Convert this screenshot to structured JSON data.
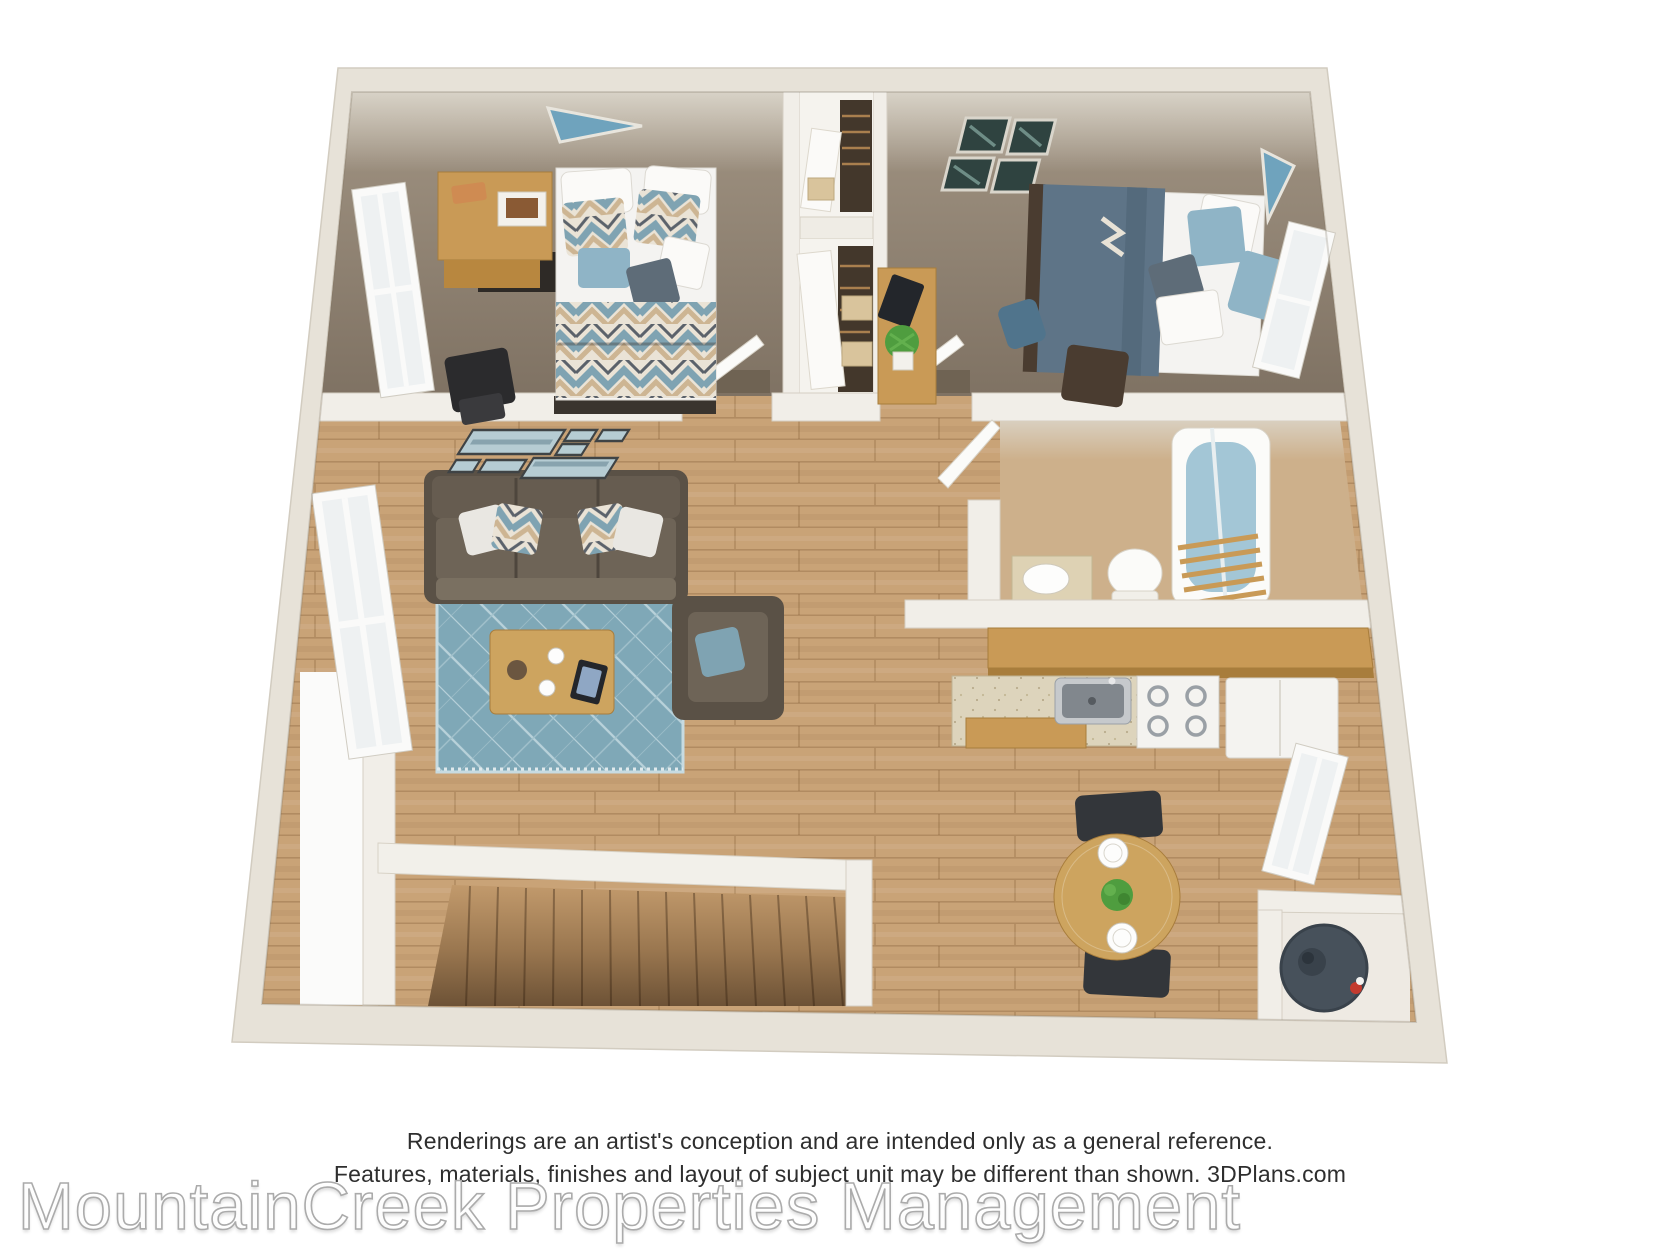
{
  "footer": {
    "disclaimer_line1": "Renderings are an artist's conception and are intended only as a general reference.",
    "disclaimer_line2": "Features, materials, finishes and layout of subject unit may be different than shown. 3DPlans.com",
    "watermark": "MountainCreek Properties Management",
    "brand": "3DPlans.com"
  },
  "palette": {
    "background": "#ffffff",
    "wall_cream": "#e7e2d8",
    "wall_inner_face": "#dedace",
    "interior_wall_white": "#f1eee8",
    "carpet_taupe": "#87796a",
    "wood_floor": "#c9a377",
    "stair_wood_dark": "#6d5236",
    "rug_blue": "#7fa8b7",
    "sofa_brown": "#5a5146",
    "oak_furniture": "#c99a56",
    "duvet_slate_blue": "#5e7487",
    "pillow_light_blue": "#8fb4c6",
    "tub_water_blue": "#a3c6d6",
    "appliance_white": "#f4f3f0",
    "water_heater_slate": "#47515b",
    "art_blue": "#6fa3bd"
  },
  "floorplan": {
    "type": "3d-top-down-apartment-rendering",
    "rooms": [
      {
        "name": "bedroom-1",
        "furniture": [
          "double-bed-chevron-duvet",
          "oak-desk",
          "black-chair",
          "closet",
          "left-wall-window",
          "blue-wall-art"
        ]
      },
      {
        "name": "bedroom-2",
        "furniture": [
          "bed-slate-duvet",
          "oak-desk-with-plant",
          "backpack",
          "chair",
          "gallery-pictures",
          "right-wall-window",
          "blue-wall-art"
        ]
      },
      {
        "name": "hallway",
        "furniture": [
          "bedroom-door-1",
          "bedroom-door-2"
        ]
      },
      {
        "name": "bathroom",
        "furniture": [
          "vanity-sink",
          "toilet",
          "bathtub",
          "towel-ladder",
          "bathroom-door"
        ]
      },
      {
        "name": "kitchen",
        "furniture": [
          "upper-cabinets",
          "counter-with-sink",
          "stove",
          "refrigerator"
        ]
      },
      {
        "name": "living-room",
        "furniture": [
          "sofa",
          "area-rug",
          "coffee-table",
          "armchair",
          "ocean-art-collage",
          "left-wall-window"
        ]
      },
      {
        "name": "dining-area",
        "furniture": [
          "round-table",
          "two-chairs",
          "place-settings",
          "plant-centerpiece",
          "right-wall-window"
        ]
      },
      {
        "name": "stairwell",
        "furniture": [
          "staircase",
          "railing-half-wall"
        ]
      },
      {
        "name": "utility-closet",
        "furniture": [
          "water-heater"
        ]
      }
    ]
  }
}
